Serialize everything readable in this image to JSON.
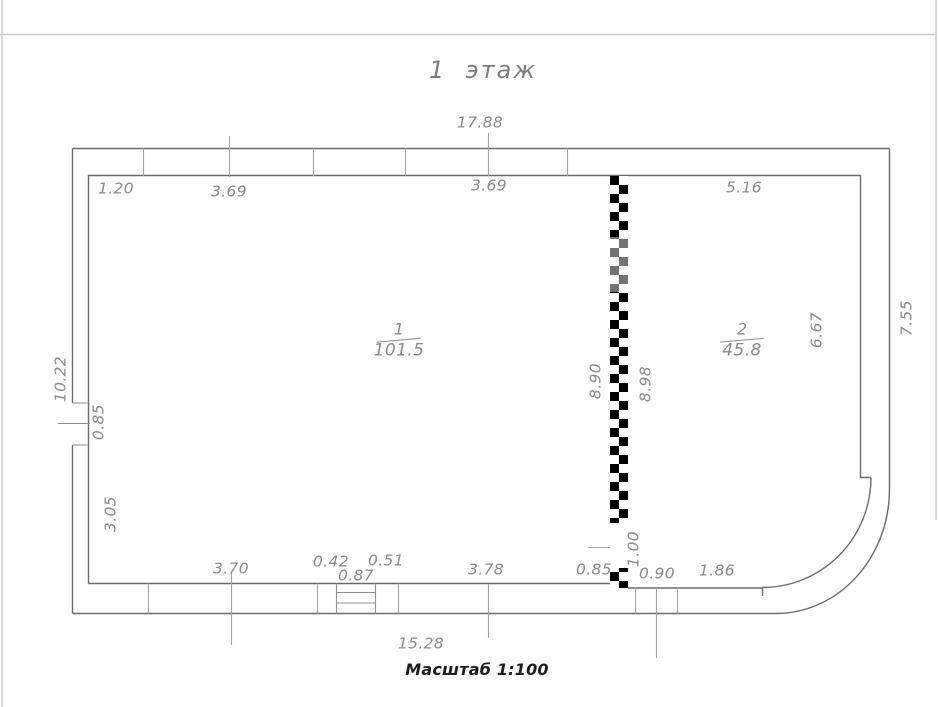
{
  "sheet": {
    "title": "1  этаж",
    "scale_note": "Масштаб 1:100"
  },
  "rooms": [
    {
      "number": "1",
      "area": "101.5"
    },
    {
      "number": "2",
      "area": "45.8"
    }
  ],
  "dimensions": {
    "top": {
      "overall": "17.88",
      "segments": [
        "1.20",
        "3.69",
        "3.69",
        "5.16"
      ]
    },
    "left": {
      "overall": "10.22",
      "window": "0.85",
      "lower": "3.05"
    },
    "right": {
      "overall": "7.55",
      "room2_height": "6.67"
    },
    "partition": {
      "left": "8.90",
      "right": "8.98",
      "door": "1.00"
    },
    "bottom": {
      "overall": "15.28",
      "segments": [
        "3.70",
        "0.42",
        "0.87",
        "0.51",
        "3.78",
        "0.85",
        "0.90",
        "1.86"
      ]
    }
  }
}
